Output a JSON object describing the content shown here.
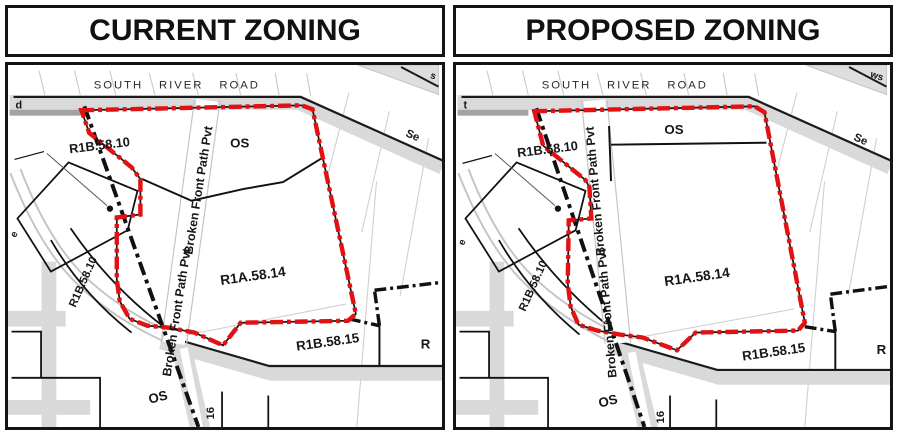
{
  "colors": {
    "boundary_red": "#e31114",
    "line_black": "#1a1a1a",
    "road_gray": "#d9d9d9",
    "road_dark_gray": "#a3a3a3",
    "parcel_gray": "#c9c9c9"
  },
  "panels": [
    {
      "title": "CURRENT ZONING",
      "labels": {
        "street": "SOUTH RIVER ROAD",
        "street_se": "Se",
        "edge_left": "d",
        "edge_corner": "s",
        "edge_side": "e",
        "parcel_upper": "R1B.58.10",
        "parcel_curve": "R1B.58.10",
        "zone_os_top": "OS",
        "zone_r1a": "R1A.58.14",
        "zone_r1b15": "R1B.58.15",
        "zone_os_bottom": "OS",
        "lot_16": "16",
        "parcel_right": "R",
        "path_name_upper": "Broken Front Path Pvt",
        "path_name_lower": "Broken Front Path Pvt"
      }
    },
    {
      "title": "PROPOSED ZONING",
      "labels": {
        "street": "SOUTH RIVER ROAD",
        "street_se": "Se",
        "edge_left": "t",
        "edge_corner": "ws",
        "edge_side": "e",
        "parcel_upper": "R1B.58.10",
        "parcel_curve": "R1B.58.10",
        "zone_os_top": "OS",
        "zone_r1a": "R1A.58.14",
        "zone_r1b15": "R1B.58.15",
        "zone_os_bottom": "OS",
        "lot_16": "16",
        "parcel_right": "R",
        "path_name_upper": "Broken Front Path Pvt",
        "path_name_lower": "Broken Front Path Pvt"
      }
    }
  ]
}
